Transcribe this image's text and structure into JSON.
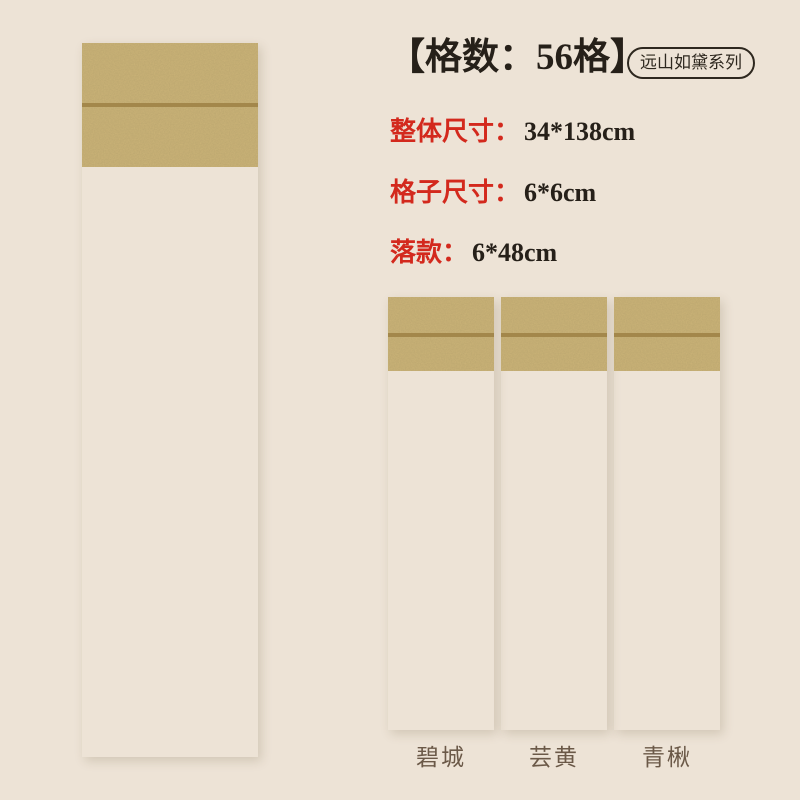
{
  "header": {
    "title": "【格数：56格】",
    "series_badge": "远山如黛系列"
  },
  "specs": [
    {
      "label": "整体尺寸：",
      "value": "34*138cm"
    },
    {
      "label": "格子尺寸：",
      "value": "6*6cm"
    },
    {
      "label": "落款：",
      "value": "6*48cm"
    }
  ],
  "grid": {
    "cols": 4,
    "rows": 16,
    "total_cells": 56,
    "signature_col": 0,
    "signature_from_row": 8
  },
  "main_scroll": {
    "mount": "#a7c7a0",
    "paper": "#e1e5c9"
  },
  "variants": [
    {
      "name": "碧城",
      "mount": "#909cab",
      "paper": "#dadcd2"
    },
    {
      "name": "芸黄",
      "mount": "#e5b263",
      "paper": "#ecdfa9"
    },
    {
      "name": "青楸",
      "mount": "#a5c79f",
      "paper": "#dde3c7"
    }
  ],
  "colors": {
    "background": "#ede3d6",
    "accent_red": "#d3291d",
    "text_dark": "#262019",
    "brocade_band": "#ccb478",
    "band_edge": "#a3874b",
    "grid_line": "rgba(115,112,78,0.5)",
    "grid_border": "rgba(115,112,78,0.8)",
    "label_text": "#6b5948"
  }
}
